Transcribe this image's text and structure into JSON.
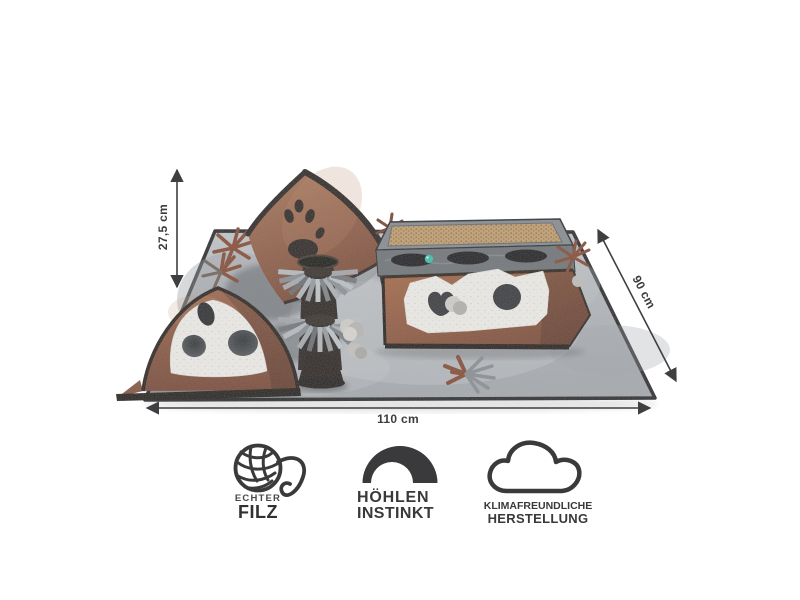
{
  "meta": {
    "type": "product-dimension-infographic",
    "background": "#ffffff"
  },
  "dimensions": {
    "height_label": "27,5 cm",
    "width_label": "110 cm",
    "depth_label": "90 cm"
  },
  "features": [
    {
      "icon": "yarn-ball-icon",
      "line1": "ECHTER",
      "line2": "FILZ"
    },
    {
      "icon": "cave-arch-icon",
      "line1": "HÖHLEN",
      "line2": "INSTINKT"
    },
    {
      "icon": "cloud-icon",
      "line1": "KLIMAFREUNDLICHE",
      "line2": "HERSTELLUNG"
    }
  ],
  "colors": {
    "annotation": "#3e3f41",
    "icon": "#3a3a3c",
    "mat_gray": "#b3b7bb",
    "felt_brown": "#9a6750",
    "felt_white": "#ebe9e5",
    "trim_black": "#2b2523",
    "cardboard": "#c2a276",
    "fringe_gray": "#a9aeb2",
    "ball_teal": "#3fbfae"
  }
}
